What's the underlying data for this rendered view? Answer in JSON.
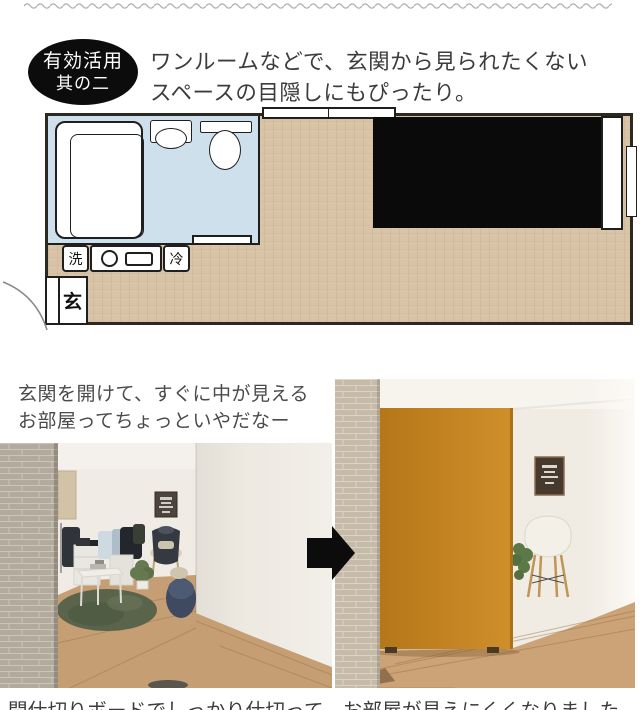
{
  "badge": {
    "line1": "有効活用",
    "line2": "其の二"
  },
  "headline": {
    "line1": "ワンルームなどで、玄関から見られたくない",
    "line2": "スペースの目隠しにもぴったり。"
  },
  "floorplan": {
    "label_wash": "洗",
    "label_fridge": "冷",
    "label_entrance": "玄"
  },
  "caption_before": {
    "line1": "玄関を開けて、すぐに中が見える",
    "line2": "お部屋ってちょっといやだなー"
  },
  "caption_after": {
    "text": "間仕切りボードでしっかり仕切って、お部屋が見えにくくなりました"
  },
  "colors": {
    "badge_bg": "#0c0c0c",
    "partition_orange": "#c5831c",
    "plan_floor_wood": "#d9c4a8",
    "bathroom_blue": "#cfe0ed",
    "bed_black": "#0a0a0a",
    "arrow_black": "#0c0c0c",
    "wave_gray": "#b3b3b3",
    "rug_green": "#59644b",
    "text_dark": "#3c3c3c"
  }
}
